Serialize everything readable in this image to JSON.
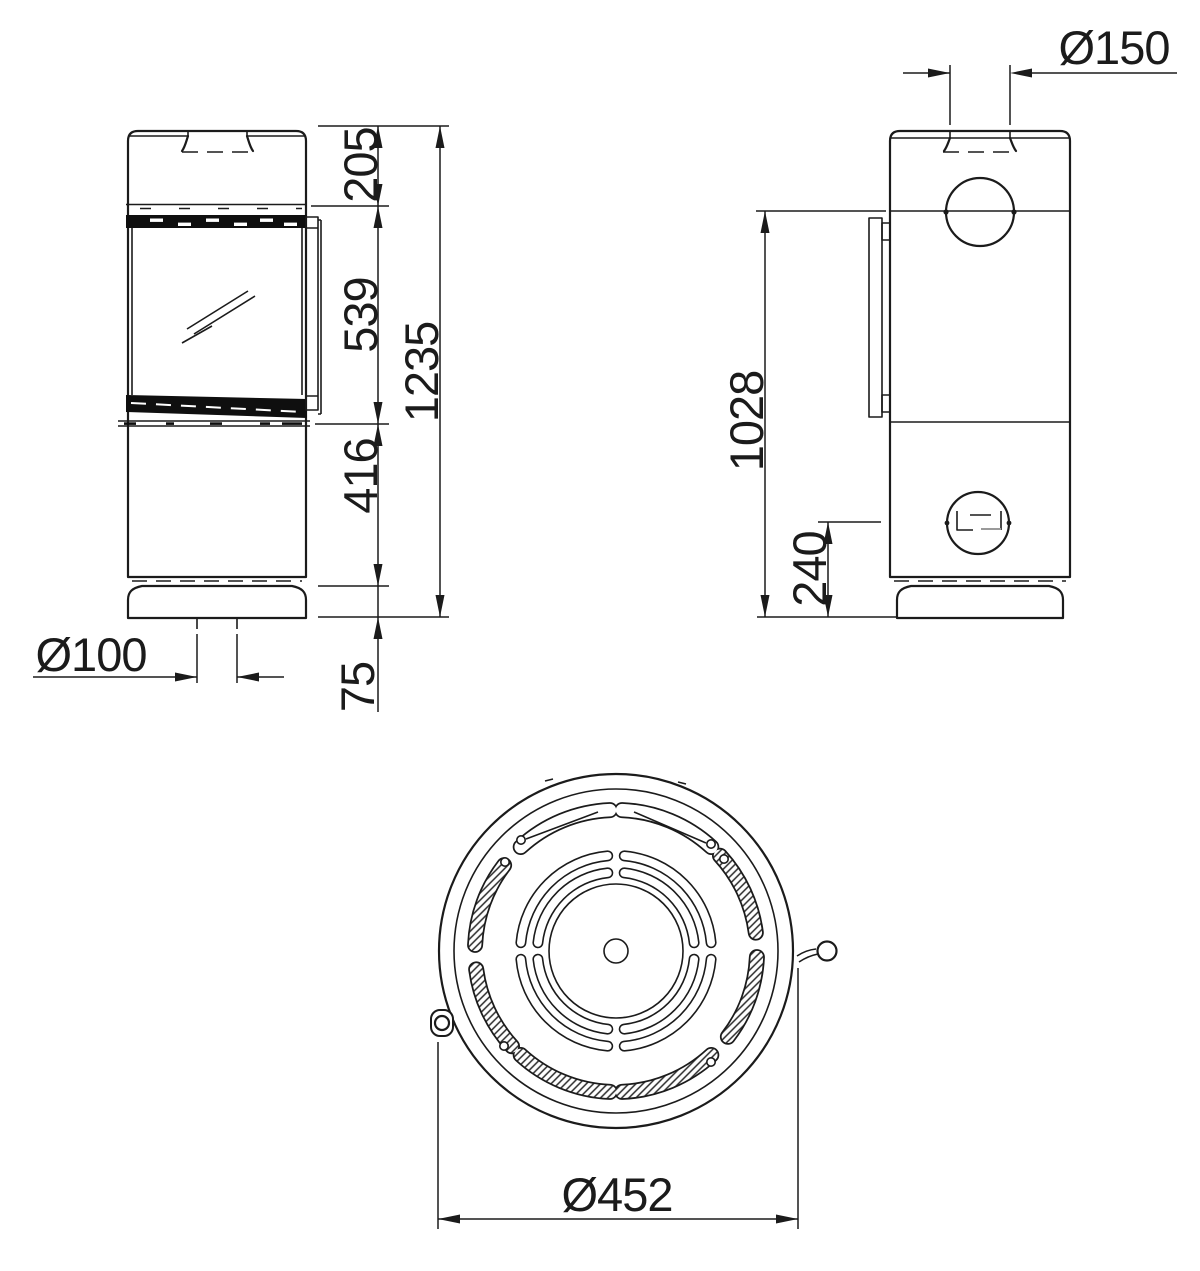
{
  "dimensions": {
    "front": {
      "top_section_height": "205",
      "door_height": "539",
      "lower_section_height": "416",
      "total_height": "1235",
      "base_height": "75",
      "floor_flue_diameter": "Ø100"
    },
    "side": {
      "flue_diameter": "Ø150",
      "rear_outlet_center_height": "1028",
      "lower_outlet_center_height": "240"
    },
    "top": {
      "body_diameter": "Ø452"
    }
  },
  "colors": {
    "line": "#1b1b1b",
    "dark_fill": "#0f0f0f",
    "gray_detail": "#9a9a9a",
    "background": "#ffffff"
  }
}
